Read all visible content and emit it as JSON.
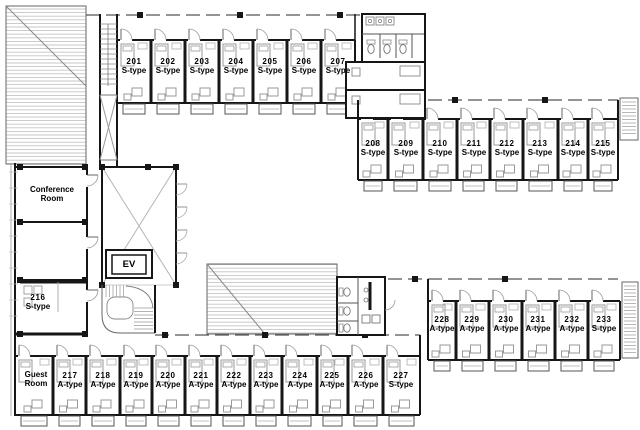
{
  "plan": {
    "conference_room": {
      "line1": "Conference",
      "line2": "Room"
    },
    "guest_room": {
      "line1": "Guest",
      "line2": "Room"
    },
    "elevator_label": "EV"
  },
  "colors": {
    "wall": "#161616",
    "furniture": "#9a9a9a",
    "hatch": "#bdbdbd",
    "door": "#999999",
    "text": "#000000"
  },
  "rooms": {
    "201": {
      "number": "201",
      "type": "S-type"
    },
    "202": {
      "number": "202",
      "type": "S-type"
    },
    "203": {
      "number": "203",
      "type": "S-type"
    },
    "204": {
      "number": "204",
      "type": "S-type"
    },
    "205": {
      "number": "205",
      "type": "S-type"
    },
    "206": {
      "number": "206",
      "type": "S-type"
    },
    "207": {
      "number": "207",
      "type": "S-type"
    },
    "208": {
      "number": "208",
      "type": "S-type"
    },
    "209": {
      "number": "209",
      "type": "S-type"
    },
    "210": {
      "number": "210",
      "type": "S-type"
    },
    "211": {
      "number": "211",
      "type": "S-type"
    },
    "212": {
      "number": "212",
      "type": "S-type"
    },
    "213": {
      "number": "213",
      "type": "S-type"
    },
    "214": {
      "number": "214",
      "type": "S-type"
    },
    "215": {
      "number": "215",
      "type": "S-type"
    },
    "216": {
      "number": "216",
      "type": "S-type"
    },
    "217": {
      "number": "217",
      "type": "A-type"
    },
    "218": {
      "number": "218",
      "type": "A-type"
    },
    "219": {
      "number": "219",
      "type": "A-type"
    },
    "220": {
      "number": "220",
      "type": "A-type"
    },
    "221": {
      "number": "221",
      "type": "A-type"
    },
    "222": {
      "number": "222",
      "type": "A-type"
    },
    "223": {
      "number": "223",
      "type": "A-type"
    },
    "224": {
      "number": "224",
      "type": "A-type"
    },
    "225": {
      "number": "225",
      "type": "A-type"
    },
    "226": {
      "number": "226",
      "type": "A-type"
    },
    "227": {
      "number": "227",
      "type": "S-type"
    },
    "228": {
      "number": "228",
      "type": "A-type"
    },
    "229": {
      "number": "229",
      "type": "A-type"
    },
    "230": {
      "number": "230",
      "type": "A-type"
    },
    "231": {
      "number": "231",
      "type": "A-type"
    },
    "232": {
      "number": "232",
      "type": "A-type"
    },
    "233": {
      "number": "233",
      "type": "S-type"
    }
  }
}
